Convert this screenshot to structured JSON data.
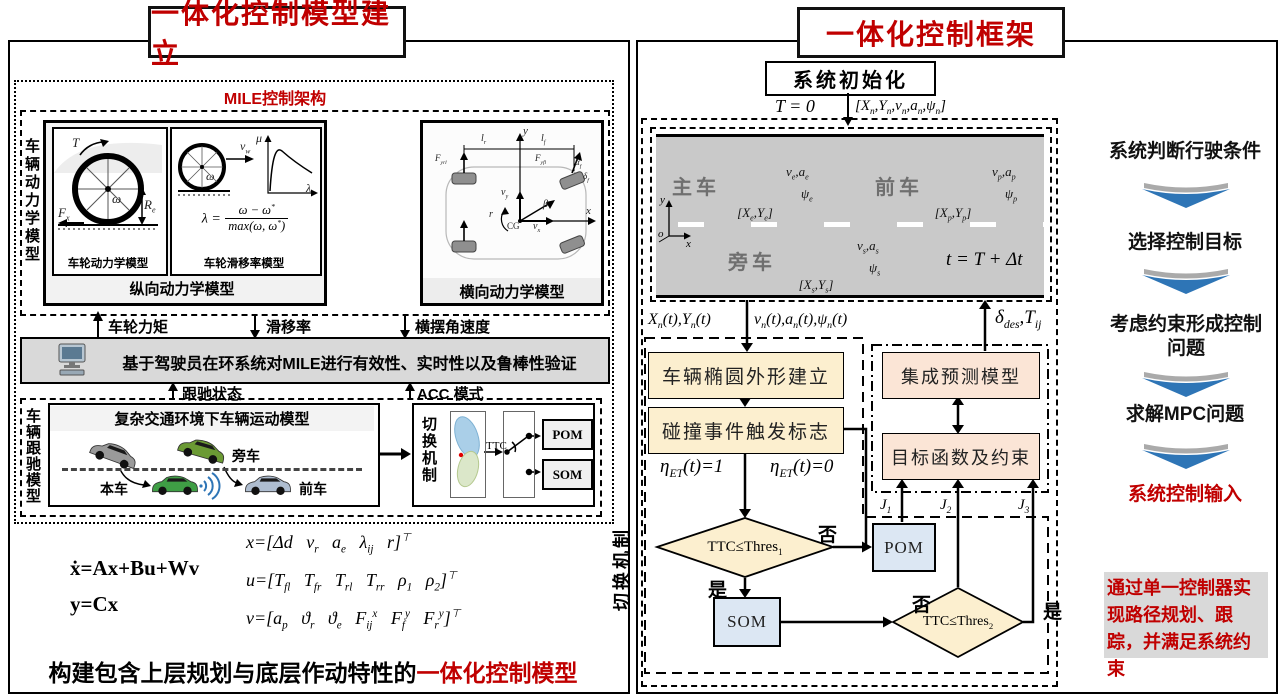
{
  "colors": {
    "accent_red": "#c00000",
    "box_yellow": "#fcefcf",
    "box_peach": "#fbe5d6",
    "box_blue": "#dce7f3",
    "bar_gray": "#d9d9d9",
    "road_gray": "#c9c9c9",
    "arrow_blue": "#2e75b6"
  },
  "left_panel": {
    "title": "一体化控制模型建立",
    "mile_label": "MILE控制架构",
    "vehicle_dynamics_label": "车辆动力学模型",
    "longitudinal_label": "纵向动力学模型",
    "wheel_model_caption": "车轮动力学模型",
    "slip_model_caption": "车轮滑移率模型",
    "wheel_labels": {
      "torque": "T",
      "omega": "ω",
      "fx": "F_{x}",
      "re": "R_{e}"
    },
    "slip_labels": {
      "vw": "v_{w}",
      "omega": "ω",
      "mu": "μ",
      "lambda": "λ"
    },
    "slip_formula": {
      "lhs": "λ =",
      "num": "ω − ω^{*}",
      "den": "max(ω, ω^{*})"
    },
    "lateral_label": "横向动力学模型",
    "lateral_labels": {
      "y": "y",
      "x": "x",
      "lr": "l_{r}",
      "lf": "l_{f}",
      "cg": "CG",
      "beta": "β",
      "vx": "v_{x}",
      "vy": "v_{y}",
      "r": "r",
      "f_rl": "F_{yrl}",
      "f_fl": "F_{yfl}",
      "alpha_f": "α_{f}",
      "delta_f": "δ_{f}"
    },
    "signal_wheel_torque": "车轮力矩",
    "signal_slip": "滑移率",
    "signal_yaw": "横摆角速度",
    "validation_text": "基于驾驶员在环系统对MILE进行有效性、实时性以及鲁棒性验证",
    "follow_state": "跟驰状态",
    "acc_mode": "ACC 模式",
    "follow_model_label": "车辆跟驰模型",
    "scene_title": "复杂交通环境下车辆运动模型",
    "scene_side": "旁车",
    "scene_ego": "本车",
    "scene_front": "前车",
    "switch_label": "切换机制",
    "ttc": "TTC",
    "pom": "POM",
    "som": "SOM",
    "eq_state": "ẋ=Ax+Bu+Wv",
    "eq_output": "y=Cx",
    "eq_x": "x=[Δd   v_{r}   a_{e}   λ_{ij}   r]^{⊤}",
    "eq_u": "u=[T_{fl}   T_{fr}   T_{rl}   T_{rr}   ρ_{1}   ρ_{2}]^{⊤}",
    "eq_v": "v=[a_{p}   ϑ_{r}   ϑ_{e}   F_{ij}^{x}   F_{f}^{y}   F_{r}^{y}]^{⊤}",
    "slogan_black": "构建包含上层规划与底层作动特性的",
    "slogan_red": "一体化控制模型"
  },
  "right_panel": {
    "title": "一体化控制框架",
    "init_label": "系统初始化",
    "t0": "T = 0",
    "init_vector": "[X_{n},Y_{n},v_{n},a_{n},ψ_{n}]",
    "road": {
      "ego": "主车",
      "front": "前车",
      "side": "旁车",
      "ego_pos": "[X_{e},Y_{e}]",
      "front_pos": "[X_{p},Y_{p}]",
      "side_pos": "[X_{s},Y_{s}]",
      "ego_v": "v_{e},a_{e}",
      "front_v": "v_{p},a_{p}",
      "side_v": "v_{s},a_{s}",
      "ego_psi": "ψ_{e}",
      "front_psi": "ψ_{p}",
      "side_psi": "ψ_{s}",
      "t_update": "t = T + Δt",
      "axis_y": "y",
      "axis_o": "o",
      "axis_x": "x"
    },
    "sig_pos": "X_{n}(t),Y_{n}(t)",
    "sig_motion": "v_{n}(t),a_{n}(t),ψ_{n}(t)",
    "sig_control": "δ_{des},T_{ij}",
    "ellipse_box": "车辆椭圆外形建立",
    "collision_box": "碰撞事件触发标志",
    "eta_one": "η_{ET}(t)=1",
    "eta_zero": "η_{ET}(t)=0",
    "ttc1": "TTC≤Thres_{1}",
    "ttc2": "TTC≤Thres_{2}",
    "no": "否",
    "yes": "是",
    "pom": "POM",
    "som": "SOM",
    "predict_box": "集成预测模型",
    "objective_box": "目标函数及约束",
    "j1": "J_{1}",
    "j2": "J_{2}",
    "j3": "J_{3}",
    "switch_label": "切换机制",
    "steps": [
      "系统判断行驶条件",
      "选择控制目标",
      "考虑约束形成控制问题",
      "求解MPC问题",
      "系统控制输入"
    ],
    "note": "通过单一控制器实现路径规划、跟踪，并满足系统约束"
  }
}
